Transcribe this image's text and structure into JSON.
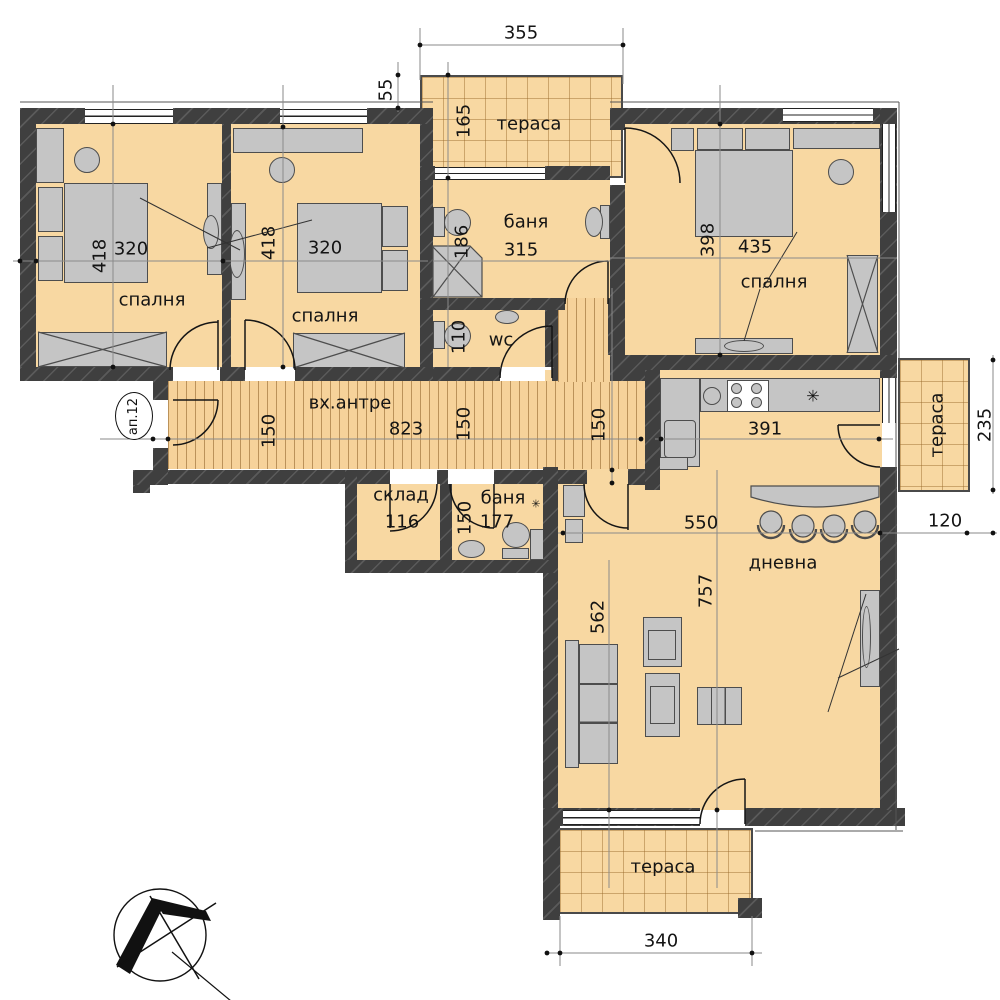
{
  "labels": {
    "apartment_badge": "ап.12",
    "terrace_top": "тераса",
    "terrace_right": "тераса",
    "terrace_bottom": "тераса",
    "bedroom1": "спалня",
    "bedroom2": "спалня",
    "bedroom3": "спалня",
    "bath_main": "баня",
    "bath_small": "баня",
    "wc": "wc",
    "hall": "вх.антре",
    "storage": "склад",
    "living": "дневна",
    "fridge_symbol": "✳",
    "boiler_symbol": "✳"
  },
  "dims": {
    "terrace_top_width": "355",
    "terrace_top_offset": "55",
    "terrace_top_depth": "165",
    "bedroom1_depth": "418",
    "bedroom1_width": "320",
    "bedroom2_depth": "418",
    "bedroom2_width": "320",
    "bedroom3_depth": "398",
    "bedroom3_width": "435",
    "bath_main_width": "315",
    "bath_main_inner": "186",
    "wc_inner": "110",
    "hall_length": "823",
    "hall_width_a": "150",
    "hall_width_b": "150",
    "corridor_width": "150",
    "storage_width": "116",
    "bath_small_width": "177",
    "bath_small_inner": "150",
    "kitchen_width": "391",
    "living_width": "550",
    "living_length": "757",
    "living_side": "562",
    "terrace_right_depth": "235",
    "terrace_right_width": "120",
    "terrace_bottom_width": "340"
  }
}
